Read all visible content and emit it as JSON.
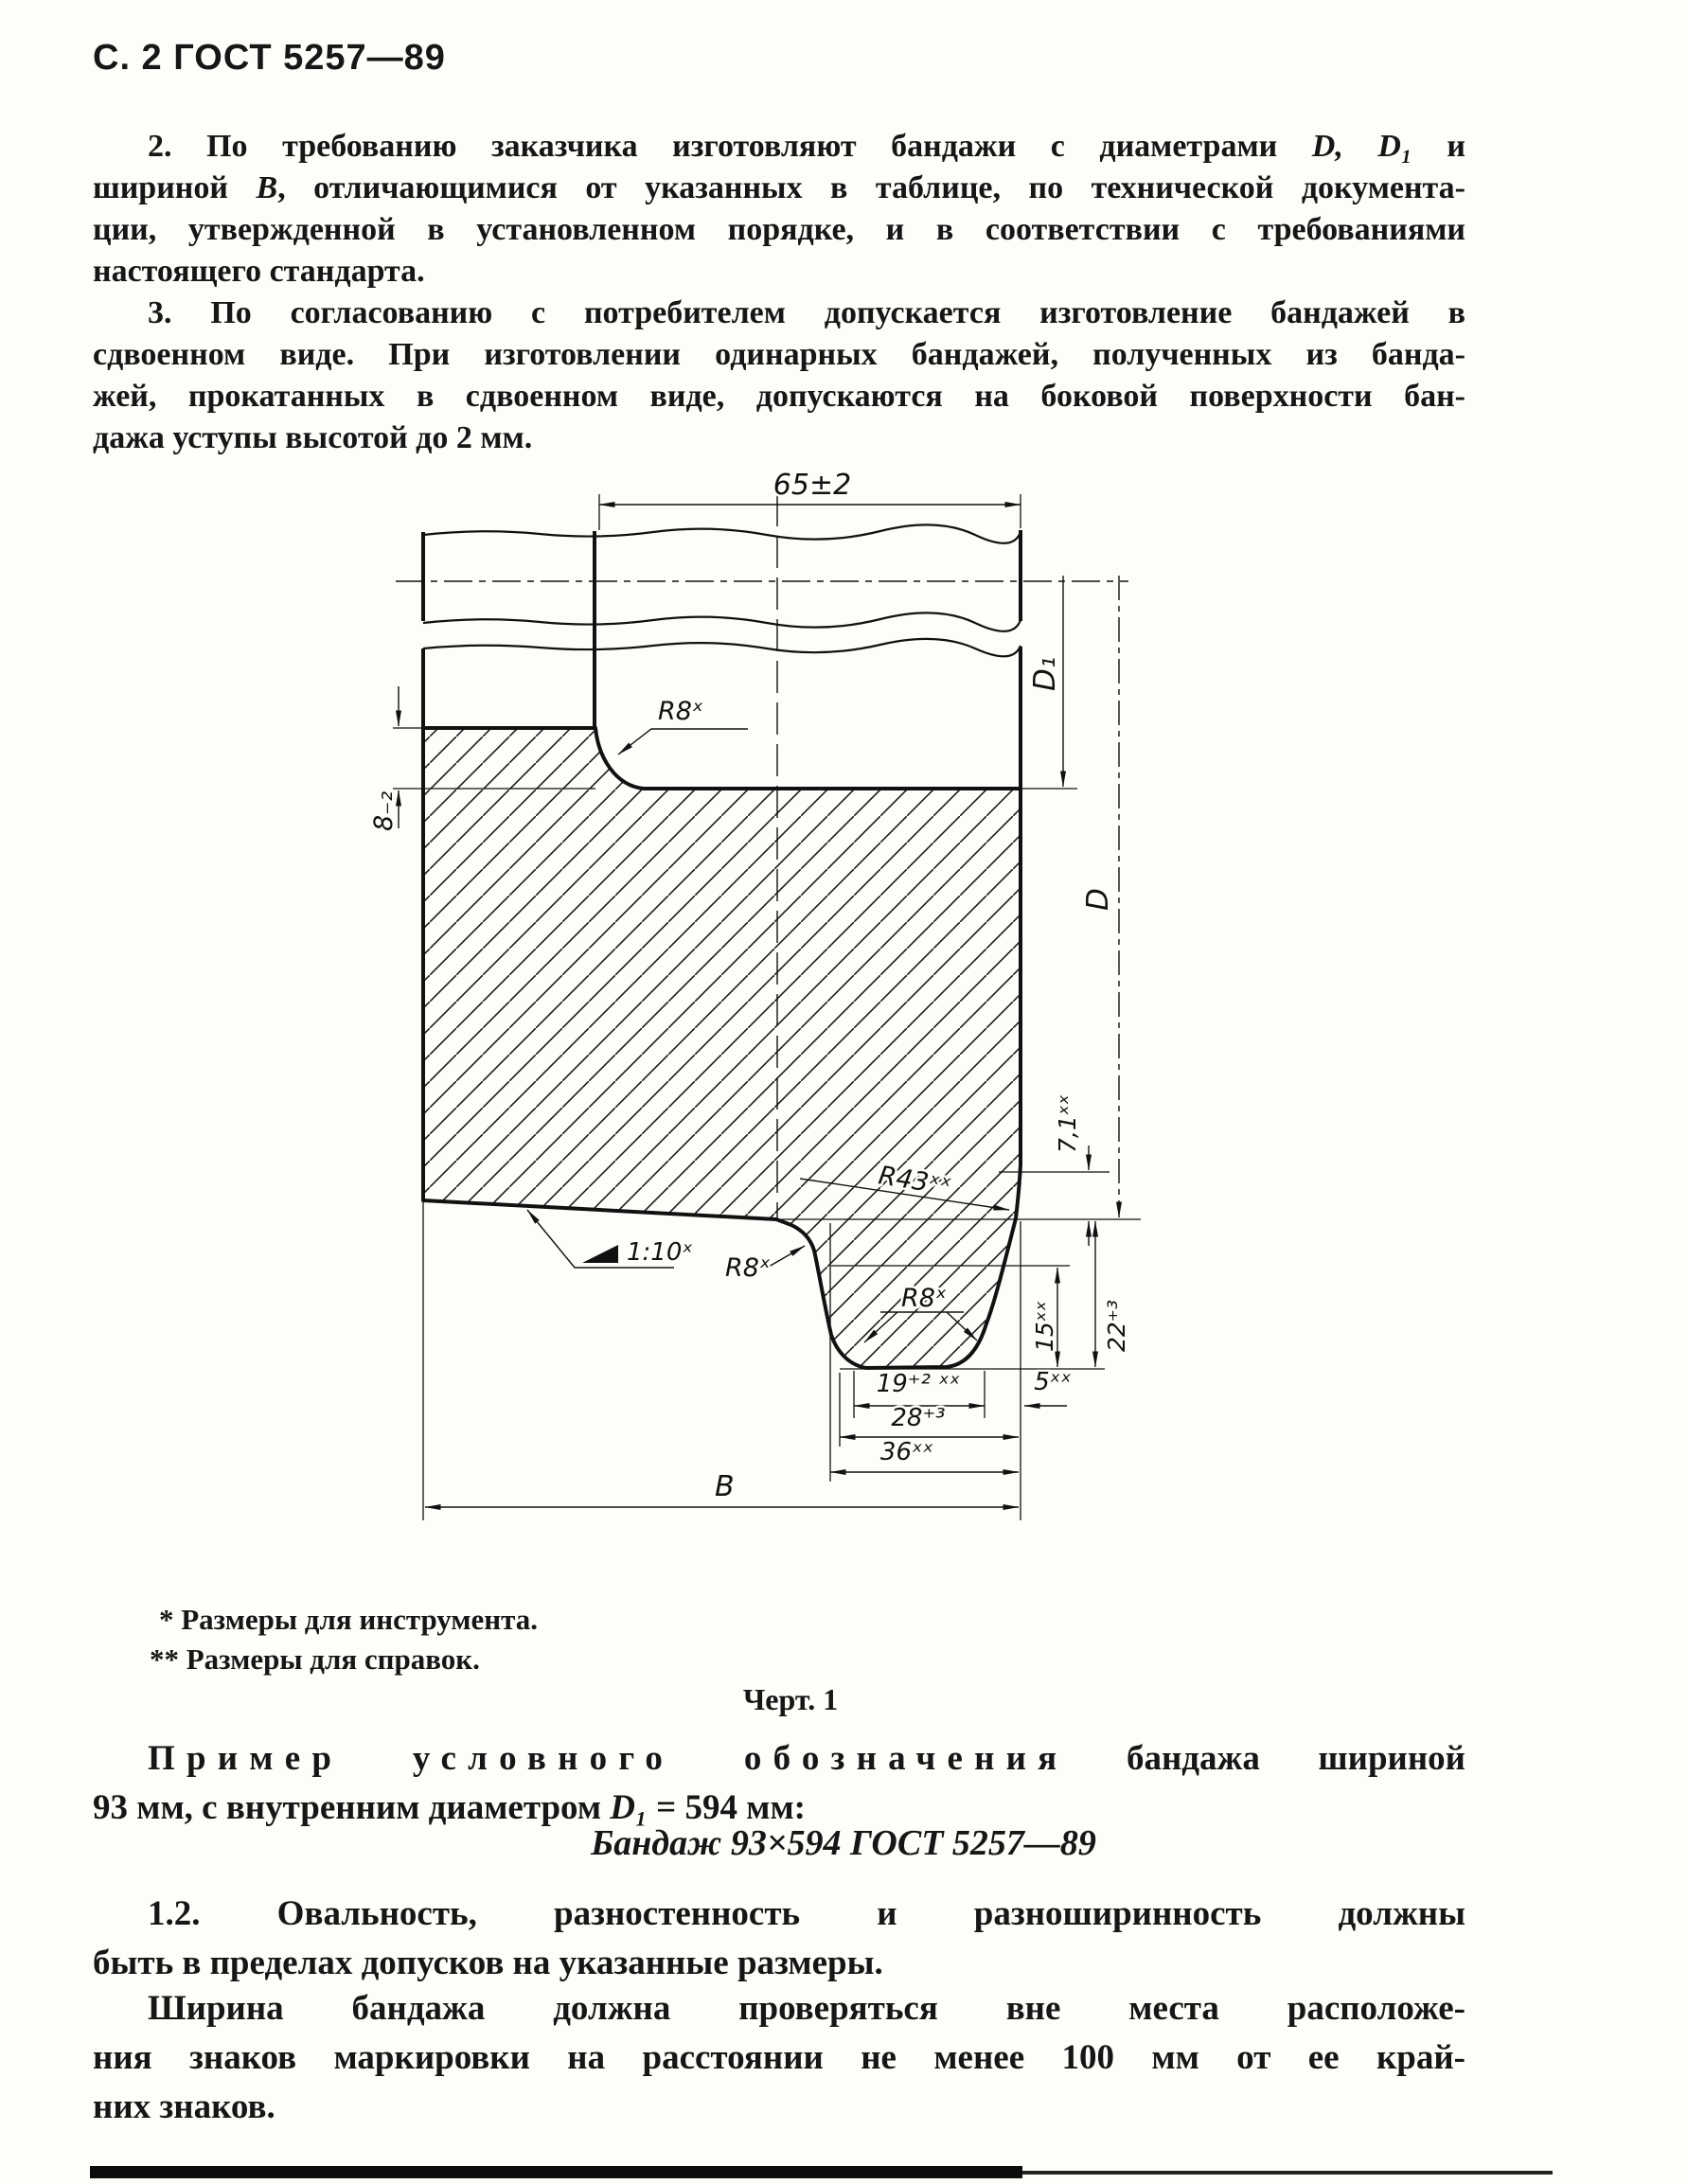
{
  "page": {
    "header": "С. 2 ГОСТ 5257—89"
  },
  "para2": {
    "l1a": "2. По требованию заказчика изготовляют бандажи с диаметрами ",
    "l1b": "D, D₁",
    "l1c": " и",
    "l2a": "шириной ",
    "l2b": "В",
    "l2c": ", отличающимися от указанных в таблице, по технической документа-",
    "l3": "ции, утвержденной в установленном порядке, и в соответствии с требованиями",
    "l4": "настоящего стандарта."
  },
  "para3": {
    "l1": "3. По согласованию с потребителем допускается изготовление бандажей в",
    "l2": "сдвоенном виде. При изготовлении одинарных бандажей, полученных из банда-",
    "l3": "жей, прокатанных в сдвоенном виде, допускаются на боковой поверхности бан-",
    "l4": "дажа уступы высотой до 2 мм."
  },
  "figure": {
    "footnote_tool": "*  Размеры для инструмента.",
    "footnote_ref": "**  Размеры для справок.",
    "caption": "Черт. 1",
    "labels": {
      "width_top": "65±2",
      "fillet_step": "R8ˣ",
      "step_height": "8₋₂",
      "d1": "D₁",
      "d": "D",
      "r43": "R43ˣˣ",
      "h71": "7,1ˣˣ",
      "taper": "1:10ˣ",
      "fillet_side": "R8ˣ",
      "fillet_groove": "R8ˣ",
      "depth15": "15ˣˣ",
      "depth22": "22⁺³",
      "w19": "19⁺² ˣˣ",
      "w5": "5ˣˣ",
      "w28": "28⁺³",
      "w36": "36ˣˣ",
      "width_b": "В"
    }
  },
  "example": {
    "l1_spaced": "Пример условного обозначения",
    "l1_rest": " бандажа шириной",
    "l2a": "93 мм, с внутренним диаметром ",
    "l2b": "D₁",
    "l2c": " = 594 мм:",
    "designation": "Бандаж 93×594 ГОСТ 5257—89"
  },
  "para12": {
    "l1": "1.2. Овальность,  разностенность и разноширинность  должны",
    "l2": "быть в пределах допусков на указанные размеры."
  },
  "para_width": {
    "l1": "Ширина бандажа должна проверяться вне места  расположе-",
    "l2": "ния знаков маркировки на расстоянии  не менее 100 мм от ее край-",
    "l3": "них знаков."
  }
}
